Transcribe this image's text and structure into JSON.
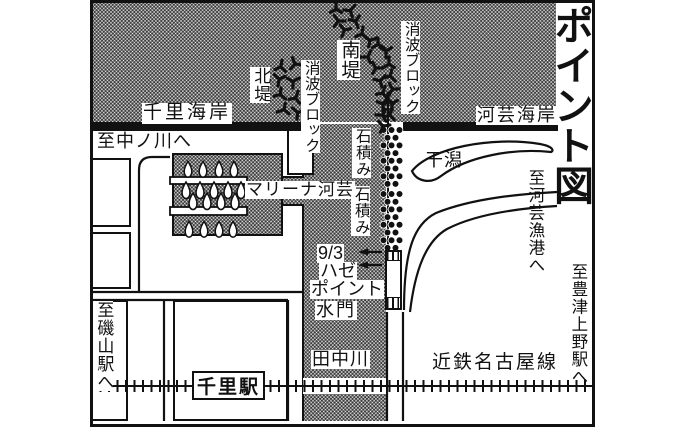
{
  "map": {
    "title": "ポイント図",
    "coasts": {
      "senri": "千里海岸",
      "kawage": "河芸海岸"
    },
    "breakwaters": {
      "north_label": "北堤",
      "south_label": "南堤",
      "tetrapod_north": "消波ブロック",
      "tetrapod_south": "消波ブロック"
    },
    "jetty": {
      "ishizumi1": "石積み",
      "ishizumi2": "石積み"
    },
    "tidal_flat": "干潟",
    "marina": "マリーナ河芸",
    "fishing_point": {
      "line1": "9/3",
      "line2": "ハゼ",
      "line3": "ポイント"
    },
    "sluice_gate": "水門",
    "river": "田中川",
    "station": "千里駅",
    "rail_line": "近鉄名古屋線",
    "directions": {
      "nakanogawa": "至中ノ川へ",
      "isoyama": "至磯山駅へ",
      "kawage_port": "至河芸漁港へ",
      "toyotsu_ueno": "至豊津上野駅へ"
    },
    "colors": {
      "ink": "#111111",
      "paper": "#ffffff",
      "stipple_dot": "#3d3d3d"
    }
  },
  "symbols": {
    "tetrapods": [
      [
        336,
        8,
        0
      ],
      [
        351,
        10,
        40
      ],
      [
        339,
        21,
        90
      ],
      [
        356,
        22,
        160
      ],
      [
        344,
        31,
        200
      ],
      [
        362,
        33,
        10
      ],
      [
        371,
        40,
        70
      ],
      [
        379,
        45,
        120
      ],
      [
        368,
        56,
        30
      ],
      [
        386,
        52,
        180
      ],
      [
        377,
        68,
        90
      ],
      [
        389,
        63,
        0
      ],
      [
        381,
        80,
        45
      ],
      [
        391,
        77,
        135
      ],
      [
        383,
        92,
        20
      ],
      [
        392,
        90,
        210
      ],
      [
        384,
        104,
        60
      ],
      [
        391,
        103,
        300
      ],
      [
        383,
        116,
        150
      ],
      [
        390,
        114,
        15
      ],
      [
        384,
        126,
        80
      ],
      [
        281,
        66,
        10
      ],
      [
        296,
        64,
        100
      ],
      [
        279,
        80,
        190
      ],
      [
        294,
        81,
        60
      ],
      [
        281,
        95,
        130
      ],
      [
        296,
        97,
        20
      ],
      [
        283,
        110,
        250
      ],
      [
        297,
        112,
        310
      ],
      [
        388,
        99,
        0
      ]
    ],
    "stone_clusters": [
      {
        "y0": 130,
        "rows": 8
      },
      {
        "y0": 194,
        "rows": 8
      }
    ],
    "boat_rows": [
      {
        "y": 169,
        "s": 0.95,
        "xs": [
          188,
          203,
          219,
          234
        ]
      },
      {
        "y": 190,
        "s": 1.0,
        "xs": [
          186,
          200,
          214,
          228,
          241
        ]
      },
      {
        "y": 201,
        "s": 1.0,
        "xs": [
          193,
          207,
          221,
          235
        ]
      },
      {
        "y": 229,
        "s": 0.95,
        "xs": [
          189,
          204,
          219,
          233
        ]
      }
    ],
    "piers": [
      {
        "x": 170,
        "y": 177,
        "w": 77,
        "h": 7
      },
      {
        "x": 170,
        "y": 207,
        "w": 77,
        "h": 8
      }
    ],
    "arrows_y": [
      252,
      265
    ]
  }
}
